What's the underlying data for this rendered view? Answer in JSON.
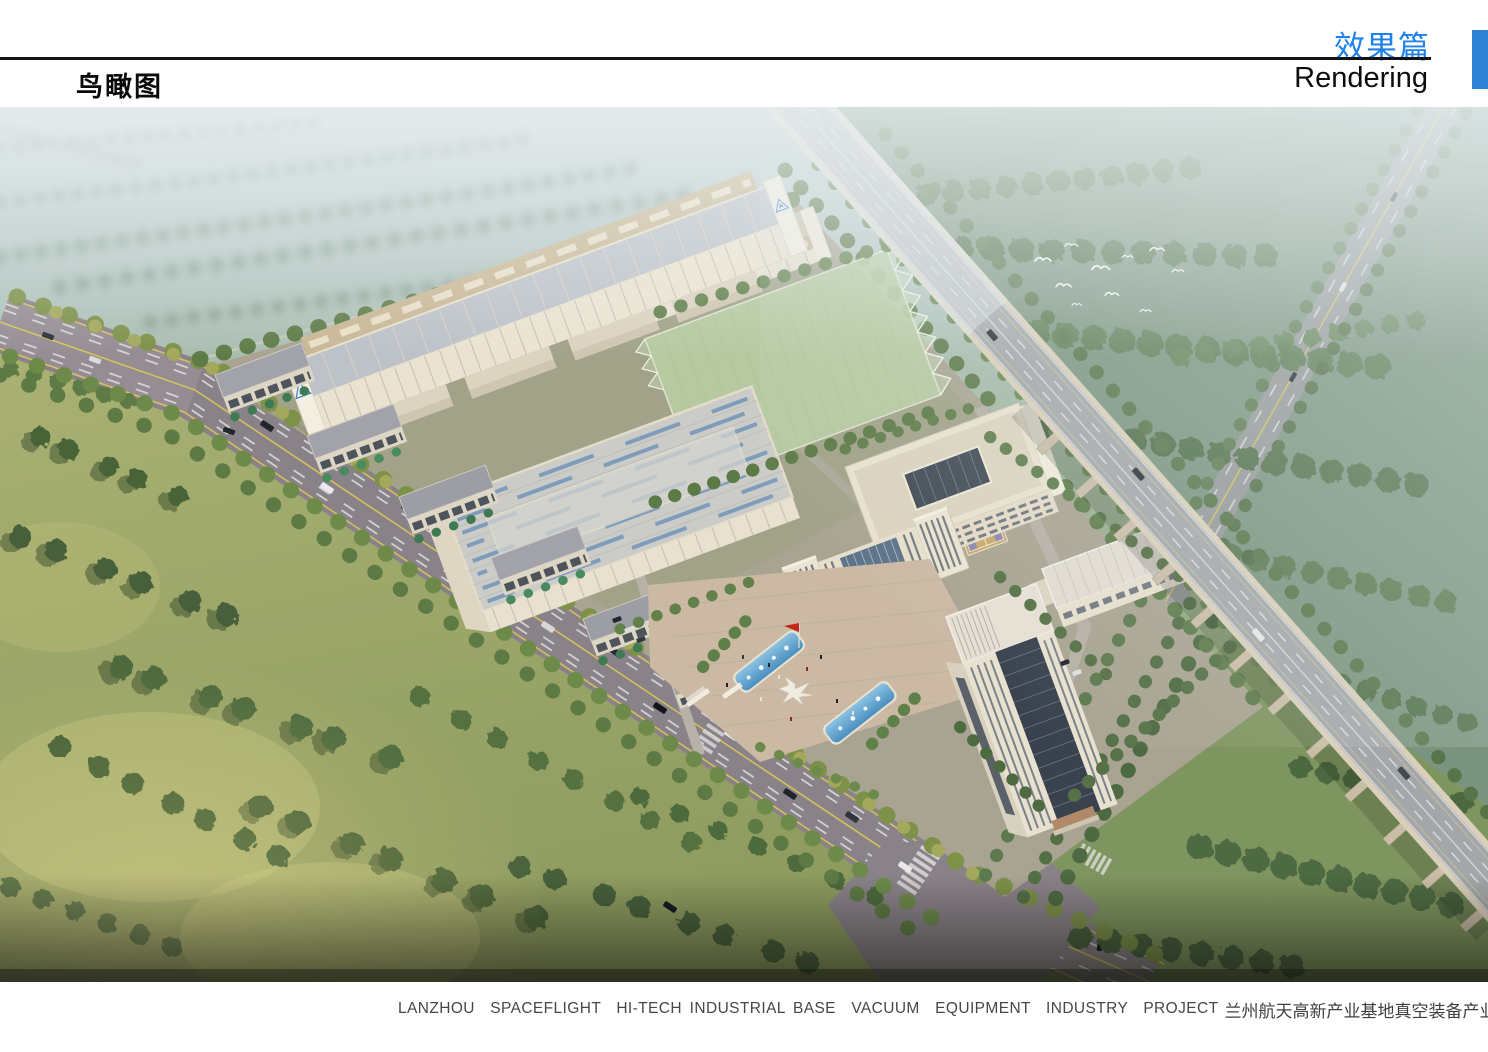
{
  "header": {
    "section_title_zh": "效果篇",
    "section_title_en": "Rendering",
    "page_title": "鸟瞰图"
  },
  "footer": {
    "project_caption_en": "LANZHOU  SPACEFLIGHT  HI-TECH INDUSTRIAL BASE  VACUUM  EQUIPMENT  INDUSTRY  PROJECT",
    "project_caption_zh": "兰州航天高新产业基地真空装备产业园项目"
  },
  "theme": {
    "accent_blue": "#2f83d6",
    "header_title_blue": "#1e82e8",
    "rule_black": "#141414",
    "caption_gray": "#474747"
  },
  "scene": {
    "kind": "aerial-birdseye-architectural-rendering",
    "features": [
      "factory-halls",
      "sports-field",
      "office-campus",
      "fountain-plaza",
      "office-tower",
      "elevated-highway",
      "tree-lined-boulevard",
      "bird-flock"
    ]
  }
}
